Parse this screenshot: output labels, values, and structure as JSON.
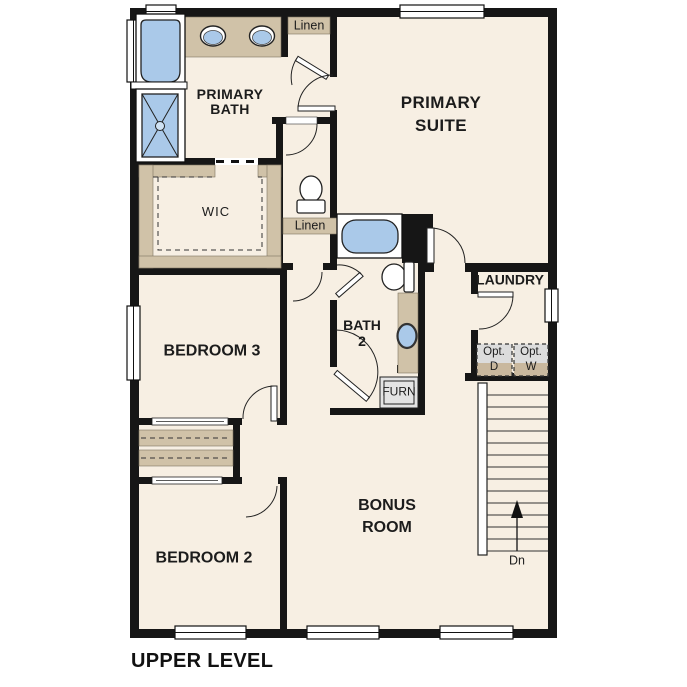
{
  "plan": {
    "level_name": "UPPER LEVEL"
  },
  "rooms": {
    "primary_suite": "PRIMARY\nSUITE",
    "primary_bath": "PRIMARY\nBATH",
    "wic": "WIC",
    "bedroom3": "BEDROOM 3",
    "bedroom2": "BEDROOM 2",
    "bath2": "BATH\n2",
    "laundry": "LAUNDRY",
    "bonus_room": "BONUS\nROOM"
  },
  "closets": {
    "linen_upper": "Linen",
    "linen_lower": "Linen"
  },
  "appliances": {
    "furnace": "FURN",
    "optional_dryer": "Opt.\nD",
    "optional_washer": "Opt.\nW"
  },
  "stairs": {
    "down_label": "Dn"
  },
  "colors": {
    "floor": "#f7efe3",
    "wall": "#161616",
    "fixture_blue": "#aac9e9",
    "casework_tan": "#d0c2a8",
    "equipment_gray": "#dcdcdc"
  }
}
